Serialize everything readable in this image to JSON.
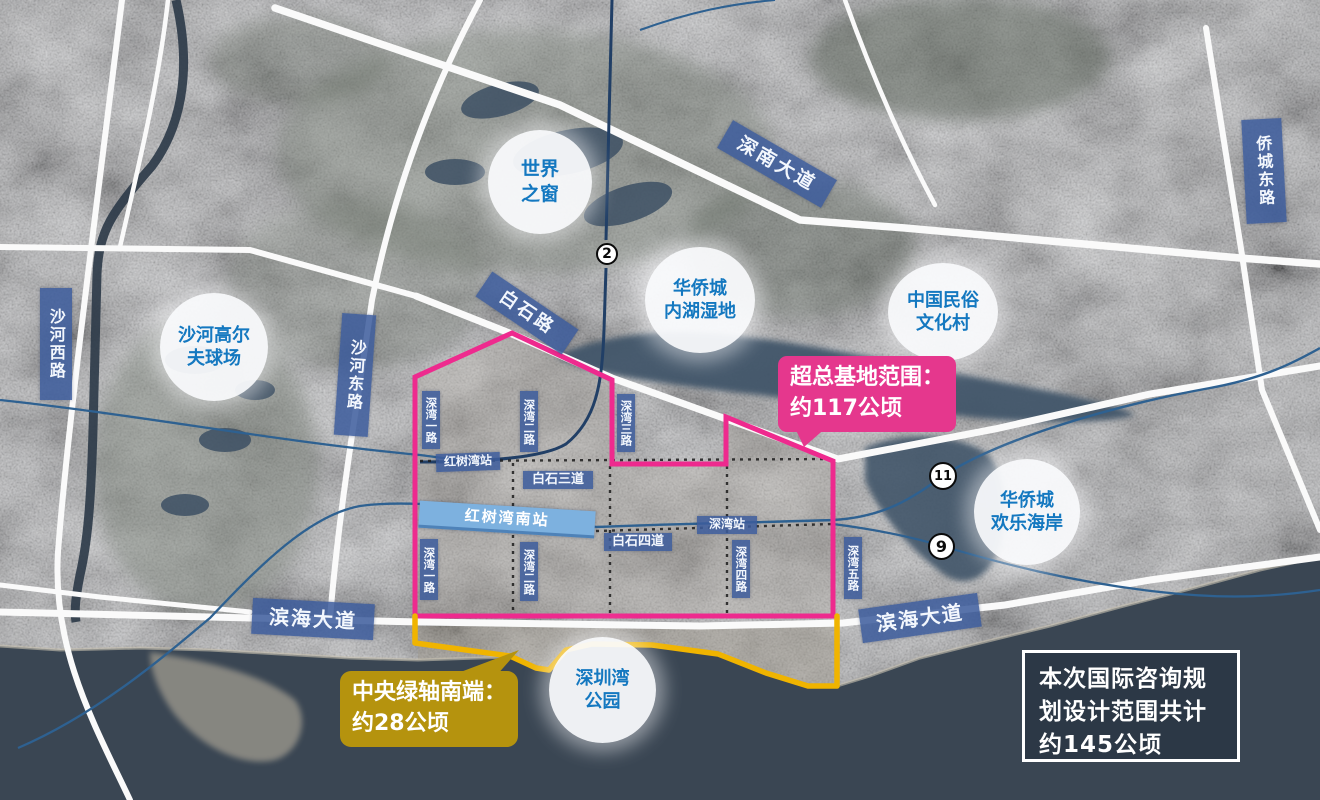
{
  "landmarks": [
    {
      "name": "沙河高尔夫球场",
      "lines": [
        "沙河高尔",
        "夫球场"
      ]
    },
    {
      "name": "世界之窗",
      "lines": [
        "世界",
        "之窗"
      ]
    },
    {
      "name": "华侨城内湖湿地",
      "lines": [
        "华侨城",
        "内湖湿地"
      ]
    },
    {
      "name": "中国民俗文化村",
      "lines": [
        "中国民俗",
        "文化村"
      ]
    },
    {
      "name": "华侨城欢乐海岸",
      "lines": [
        "华侨城",
        "欢乐海岸"
      ]
    },
    {
      "name": "深圳湾公园",
      "lines": [
        "深圳湾",
        "公园"
      ]
    }
  ],
  "roads": {
    "shahe_west": "沙河西路",
    "shahe_east": "沙河东路",
    "qiaocheng_east": "侨城东路",
    "shennan": "深南大道",
    "baishi": "白石路",
    "binhai_left": "滨海大道",
    "binhai_right": "滨海大道",
    "baishi_3": "白石三道",
    "baishi_4": "白石四道"
  },
  "stations": {
    "hongshuwan": "红树湾站",
    "hongshuwan_south": "红树湾南站",
    "shenwan": "深湾站"
  },
  "streets": {
    "shenwan_1_n": "深湾一路",
    "shenwan_2_n": "深湾二路",
    "shenwan_3": "深湾三路",
    "shenwan_1_s": "深湾一路",
    "shenwan_2_s": "深湾二路",
    "shenwan_4": "深湾四路",
    "shenwan_5": "深湾五路"
  },
  "metro_badges": {
    "line_2": "2",
    "line_11": "11",
    "line_9": "9"
  },
  "callouts": {
    "base_area": {
      "line1": "超总基地范围：",
      "line2": "约117公顷"
    },
    "green_axis": {
      "line1": "中央绿轴南端：",
      "line2": "约28公顷"
    },
    "summary": {
      "line1": "本次国际咨询规",
      "line2": "划设计范围共计",
      "line3": "约145公顷"
    }
  },
  "colors": {
    "boundary_pink": "#ee2a8e",
    "boundary_yellow": "#f0b400",
    "base_area_label": "#e5378d",
    "green_axis_label": "#b5930e",
    "road_label_bg": "#3c5c9c",
    "landmark_text": "#1478c0",
    "sea": "#3a4653"
  }
}
